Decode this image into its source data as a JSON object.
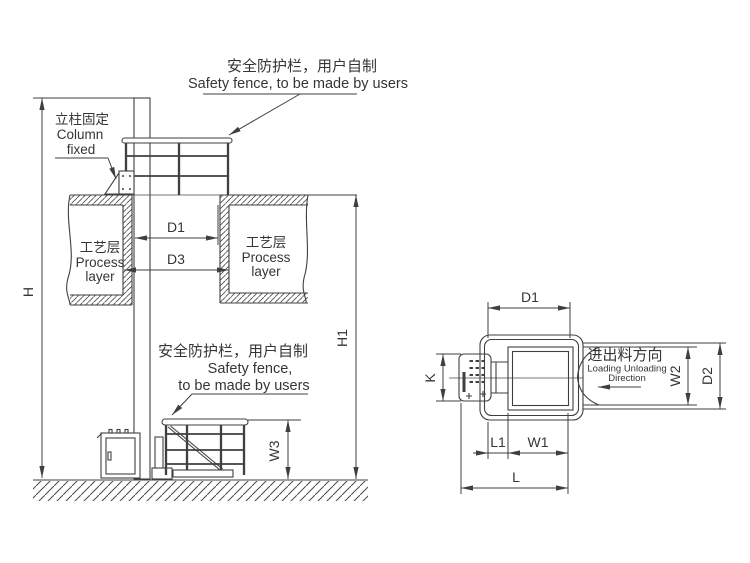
{
  "elevation": {
    "note_top": {
      "zh": "安全防护栏，用户自制",
      "en": "Safety fence, to be made by users"
    },
    "note_column": {
      "zh": "立柱固定",
      "en1": "Column",
      "en2": "fixed"
    },
    "note_bottom": {
      "zh": "安全防护栏，用户自制",
      "en1": "Safety fence,",
      "en2": "to be made by users"
    },
    "slab_left": {
      "zh": "工艺层",
      "en1": "Process",
      "en2": "layer"
    },
    "slab_right": {
      "zh": "工艺层",
      "en1": "Process",
      "en2": "layer"
    },
    "dims": {
      "h": "H",
      "h1": "H1",
      "d1": "D1",
      "d3": "D3",
      "w3": "W3"
    }
  },
  "plan": {
    "note_direction": {
      "zh": "进出料方向",
      "en1": "Loading Unloading",
      "en2": "Direction"
    },
    "dims": {
      "d1": "D1",
      "k": "K",
      "w2": "W2",
      "d2": "D2",
      "l1": "L1",
      "w1": "W1",
      "l": "L"
    }
  },
  "colors": {
    "line": "#3f3f3f",
    "background": "#ffffff"
  }
}
